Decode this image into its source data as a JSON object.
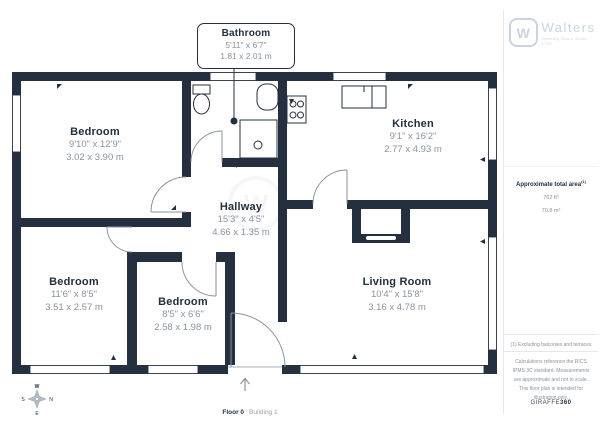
{
  "brand": {
    "name": "Walters",
    "tagline": "Opening Doors Since 1790",
    "monogram": "W"
  },
  "sidebar": {
    "area_label": "Approximate total area",
    "area_superscript": "(1)",
    "area_ft": "762 ft²",
    "area_m": "70.8 m²",
    "footnote": "(1) Excluding balconies and terraces",
    "disclaimer": "Calculations reference the RICS IPMS 3C standard. Measurements are approximate and not to scale. This floor plan is intended for illustration only.",
    "credit_prefix": "GIRAFFE",
    "credit_suffix": "360"
  },
  "rooms": [
    {
      "name": "Bathroom",
      "imperial": "5'11\" x 6'7\"",
      "metric": "1.81 x 2.01 m"
    },
    {
      "name": "Bedroom",
      "imperial": "9'10\" x 12'9\"",
      "metric": "3.02 x 3.90 m"
    },
    {
      "name": "Kitchen",
      "imperial": "9'1\" x 16'2\"",
      "metric": "2.77 x 4.93 m"
    },
    {
      "name": "Hallway",
      "imperial": "15'3\" x 4'5\"",
      "metric": "4.66 x 1.35 m"
    },
    {
      "name": "Bedroom",
      "imperial": "11'6\" x 8'5\"",
      "metric": "3.51 x 2.57 m"
    },
    {
      "name": "Bedroom",
      "imperial": "8'5\" x 6'6\"",
      "metric": "2.58 x 1.98 m"
    },
    {
      "name": "Living Room",
      "imperial": "10'4\" x 15'8\"",
      "metric": "3.16 x 4.78 m"
    }
  ],
  "footer": {
    "floor": "Floor 0",
    "building": "Building 1"
  },
  "compass": {
    "top": "W",
    "right": "N",
    "bottom": "E",
    "left": "S"
  },
  "colors": {
    "wall": "#243040",
    "text_dark": "#223042",
    "text_gray": "#8a93a0",
    "brand_light": "#c9d4de",
    "door_arc": "#8a939f"
  }
}
